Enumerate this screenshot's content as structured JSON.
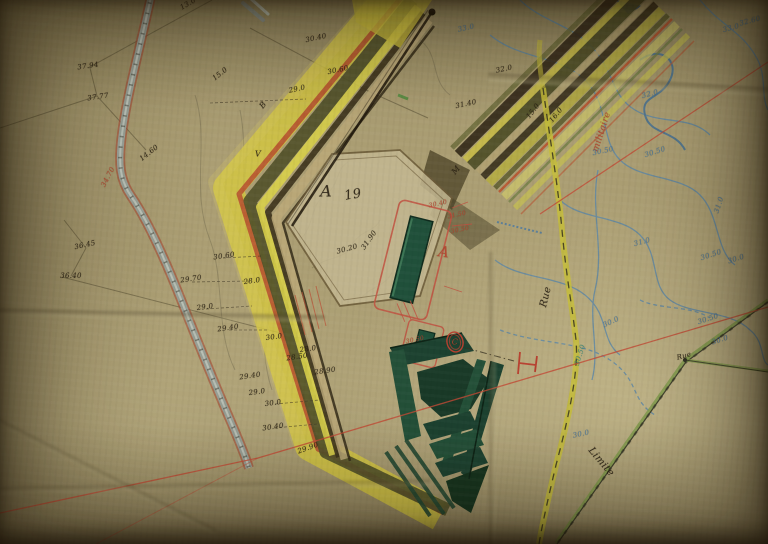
{
  "colors": {
    "paper": "#ab9e73",
    "ink": "#2b2316",
    "pencil": "#5a523a",
    "red": "#b5432e",
    "blue": "#4a78a0",
    "teal": "#3e8a78",
    "yellow": "#d2c440",
    "road_yellow": "#c6bd3a",
    "road_grey": "#93a39b",
    "crest_orange": "#b85430",
    "dark_green": "#1d4230",
    "olive": "#4c4c26",
    "boundary_green": "#7a9a45"
  },
  "map": {
    "parcel_number": "19",
    "place_names": [
      "Rue",
      "Limite",
      "militaire"
    ],
    "reference_letters": [
      "A",
      "19",
      "A",
      "C",
      "B",
      "V",
      "M"
    ],
    "labels": [
      {
        "t": "37.94",
        "x": 88,
        "y": 66,
        "r": -8
      },
      {
        "t": "37.77",
        "x": 98,
        "y": 97,
        "r": -8
      },
      {
        "t": "36.45",
        "x": 85,
        "y": 245,
        "r": -12
      },
      {
        "t": "36.40",
        "x": 71,
        "y": 276
      },
      {
        "t": "13.0",
        "x": 188,
        "y": 4,
        "r": -30
      },
      {
        "t": "15.0",
        "x": 220,
        "y": 74,
        "r": -38
      },
      {
        "t": "14.60",
        "x": 149,
        "y": 153,
        "r": -38
      },
      {
        "t": "34.70",
        "x": 108,
        "y": 177,
        "r": -62,
        "c": "red"
      },
      {
        "t": "30.40",
        "x": 316,
        "y": 38,
        "r": -12
      },
      {
        "t": "30.60",
        "x": 338,
        "y": 70,
        "r": -12
      },
      {
        "t": "29.0",
        "x": 297,
        "y": 89,
        "r": -12
      },
      {
        "t": "31.40",
        "x": 466,
        "y": 104,
        "r": -12
      },
      {
        "t": "32.0",
        "x": 504,
        "y": 69,
        "r": -12
      },
      {
        "t": "33.0",
        "x": 466,
        "y": 28,
        "r": -12,
        "c": "blue"
      },
      {
        "t": "B",
        "x": 263,
        "y": 105,
        "r": -50,
        "s": 8
      },
      {
        "t": "V",
        "x": 258,
        "y": 154,
        "s": 8
      },
      {
        "t": "M",
        "x": 456,
        "y": 170,
        "r": -50,
        "s": 8
      },
      {
        "t": "A",
        "x": 326,
        "y": 191,
        "s": 16,
        "f": "script"
      },
      {
        "t": "19",
        "x": 353,
        "y": 195,
        "r": -10,
        "s": 13
      },
      {
        "t": "31.90",
        "x": 369,
        "y": 240,
        "r": -55
      },
      {
        "t": "30.20",
        "x": 347,
        "y": 249,
        "r": -15
      },
      {
        "t": "30.60",
        "x": 224,
        "y": 256,
        "r": -8
      },
      {
        "t": "29.70",
        "x": 191,
        "y": 279,
        "r": -8
      },
      {
        "t": "28.0",
        "x": 252,
        "y": 281,
        "r": -8
      },
      {
        "t": "29.0",
        "x": 205,
        "y": 307,
        "r": -8
      },
      {
        "t": "29.40",
        "x": 228,
        "y": 328,
        "r": -8
      },
      {
        "t": "30.0",
        "x": 274,
        "y": 337,
        "r": -8
      },
      {
        "t": "28.50",
        "x": 297,
        "y": 357,
        "r": -8
      },
      {
        "t": "28.0",
        "x": 308,
        "y": 349,
        "r": -8
      },
      {
        "t": "28.90",
        "x": 325,
        "y": 371,
        "r": -8
      },
      {
        "t": "29.40",
        "x": 250,
        "y": 376,
        "r": -8
      },
      {
        "t": "29.0",
        "x": 257,
        "y": 392,
        "r": -8
      },
      {
        "t": "30.0",
        "x": 273,
        "y": 403,
        "r": -8
      },
      {
        "t": "30.40",
        "x": 273,
        "y": 427,
        "r": -8
      },
      {
        "t": "29.90",
        "x": 308,
        "y": 448,
        "r": -20
      },
      {
        "t": "15.0",
        "x": 533,
        "y": 111,
        "r": -52
      },
      {
        "t": "16.0",
        "x": 556,
        "y": 115,
        "r": -52
      },
      {
        "t": "militaire",
        "x": 602,
        "y": 132,
        "r": -72,
        "s": 9,
        "c": "red",
        "f": "script"
      },
      {
        "t": "A",
        "x": 444,
        "y": 252,
        "r": 8,
        "s": 15,
        "c": "red",
        "f": "script"
      },
      {
        "t": "C",
        "x": 455,
        "y": 342,
        "s": 8,
        "c": "red",
        "f": "script"
      },
      {
        "t": "30.40",
        "x": 438,
        "y": 204,
        "r": -12,
        "s": 6,
        "c": "red"
      },
      {
        "t": "31.50",
        "x": 457,
        "y": 215,
        "r": -12,
        "s": 6,
        "c": "red"
      },
      {
        "t": "30.50",
        "x": 460,
        "y": 230,
        "r": -12,
        "s": 6,
        "c": "red"
      },
      {
        "t": "30.50",
        "x": 415,
        "y": 340,
        "r": -12,
        "s": 6,
        "c": "red"
      },
      {
        "t": "32.60",
        "x": 750,
        "y": 21,
        "r": -15,
        "c": "blue"
      },
      {
        "t": "33.0",
        "x": 731,
        "y": 28,
        "r": -15,
        "c": "blue"
      },
      {
        "t": "32.0",
        "x": 650,
        "y": 94,
        "r": -15,
        "c": "blue"
      },
      {
        "t": "30.50",
        "x": 603,
        "y": 151,
        "r": -12,
        "c": "blue"
      },
      {
        "t": "30.50",
        "x": 655,
        "y": 152,
        "r": -18,
        "c": "blue"
      },
      {
        "t": "31.0",
        "x": 719,
        "y": 205,
        "r": -72,
        "c": "blue"
      },
      {
        "t": "31.0",
        "x": 642,
        "y": 242,
        "r": -15,
        "c": "blue"
      },
      {
        "t": "30.50",
        "x": 711,
        "y": 255,
        "r": -18,
        "c": "blue"
      },
      {
        "t": "30.0",
        "x": 736,
        "y": 259,
        "r": -18,
        "c": "blue"
      },
      {
        "t": "30.50",
        "x": 708,
        "y": 319,
        "r": -18,
        "c": "blue"
      },
      {
        "t": "30.0",
        "x": 720,
        "y": 340,
        "r": -18,
        "c": "blue"
      },
      {
        "t": "30.0",
        "x": 611,
        "y": 322,
        "r": -25,
        "c": "blue"
      },
      {
        "t": "30.0",
        "x": 581,
        "y": 434,
        "r": -12,
        "c": "blue"
      },
      {
        "t": "30.50",
        "x": 580,
        "y": 355,
        "r": -72,
        "c": "teal"
      },
      {
        "t": "Rue",
        "x": 546,
        "y": 297,
        "r": -76,
        "s": 10,
        "f": "script"
      },
      {
        "t": "Rue",
        "x": 684,
        "y": 356,
        "r": -15,
        "s": 7,
        "f": "script"
      },
      {
        "t": "Limite",
        "x": 601,
        "y": 462,
        "r": 50,
        "s": 10,
        "f": "script"
      }
    ]
  }
}
